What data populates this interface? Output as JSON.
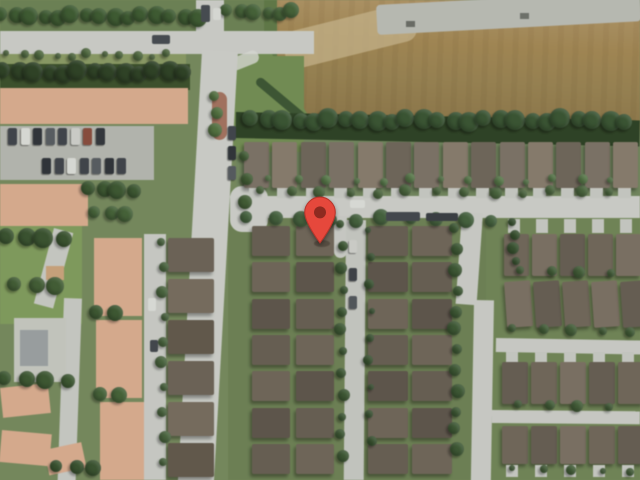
{
  "view": {
    "type": "satellite",
    "subject": "suburban residential neighborhood aerial view"
  },
  "marker": {
    "x": 320,
    "y": 244,
    "width": 36,
    "height": 48,
    "color": "#E6483C",
    "edge": "#B8352B",
    "dot": "#8E2A20"
  },
  "palette": {
    "grass_base": "#74875c",
    "road_gray": "#c8cac4",
    "dirt_field": "#9c8350",
    "concrete_strip": "#b7b9b1",
    "tree_green": "#3a5530",
    "townhouse_peach": "#d8a98a",
    "house_roof_brown": "#6e6456",
    "park_green": "#7d9a57"
  },
  "scene": {
    "ops": [
      {
        "t": "r",
        "n": "ground-top-strip",
        "x": 0,
        "y": 0,
        "w": 312,
        "h": 34,
        "c": "#6a8150"
      },
      {
        "t": "r",
        "n": "ground-houses-north",
        "x": 236,
        "y": 134,
        "w": 404,
        "h": 64,
        "c": "#6f855a"
      },
      {
        "t": "r",
        "n": "ground-block-left",
        "x": 228,
        "y": 214,
        "w": 260,
        "h": 266,
        "c": "#6b8050"
      },
      {
        "t": "r",
        "n": "ground-block-right",
        "x": 486,
        "y": 214,
        "w": 154,
        "h": 266,
        "c": "#6e8452"
      },
      {
        "t": "r",
        "n": "park-green",
        "x": 0,
        "y": 226,
        "w": 82,
        "h": 98,
        "c": "#7d9a57"
      },
      {
        "t": "r",
        "n": "dirt-field",
        "x": 274,
        "y": 0,
        "w": 366,
        "h": 130,
        "cls": "g-field"
      },
      {
        "t": "r",
        "n": "field-light-patch",
        "x": 280,
        "y": 34,
        "w": 134,
        "h": 38,
        "c": "#c6b286",
        "rot": -14,
        "rad": "12px",
        "op": 0.75
      },
      {
        "t": "r",
        "n": "field-concrete-strip",
        "x": 376,
        "y": 5,
        "w": 264,
        "h": 30,
        "c": "#b7b9b1",
        "rot": -3,
        "rad": "4px"
      },
      {
        "t": "r",
        "n": "strip-vehicle",
        "x": 406,
        "y": 21,
        "w": 9,
        "h": 6,
        "c": "#686b63"
      },
      {
        "t": "r",
        "n": "strip-vehicle",
        "x": 520,
        "y": 13,
        "w": 9,
        "h": 6,
        "c": "#6d7068"
      },
      {
        "t": "r",
        "n": "field-west-hedge",
        "x": 264,
        "y": 0,
        "w": 13,
        "h": 70,
        "c": "#5d7843"
      },
      {
        "t": "r",
        "n": "grass-field-corner",
        "x": 258,
        "y": 54,
        "w": 54,
        "h": 68,
        "c": "#6f8c4e",
        "clip": "polygon(0 0,26% 0,100% 100%,0 100%)"
      },
      {
        "t": "r",
        "n": "grass-ne-patch",
        "x": 234,
        "y": 56,
        "w": 70,
        "h": 96,
        "c": "#6f8c4e"
      },
      {
        "t": "r",
        "n": "boundary-hedge",
        "x": 260,
        "y": 76,
        "w": 66,
        "h": 9,
        "c": "#3a5530",
        "rot": 40,
        "rad": "5px"
      },
      {
        "t": "r",
        "n": "field-treeline",
        "x": 236,
        "y": 112,
        "w": 404,
        "h": 26,
        "c": "#2b4122",
        "rot": 1.2
      },
      {
        "t": "r",
        "n": "road-horizontal",
        "x": 0,
        "y": 31,
        "w": 314,
        "h": 23,
        "c": "#c8cac4"
      },
      {
        "t": "r",
        "n": "road-stub-north",
        "x": 196,
        "y": 0,
        "w": 28,
        "h": 34,
        "c": "#c8cac4"
      },
      {
        "t": "r",
        "n": "sidewalk-corner",
        "x": 228,
        "y": 60,
        "w": 30,
        "h": 13,
        "c": "#d6d7d1",
        "rot": -22,
        "rad": "6px",
        "op": 0.8
      },
      {
        "t": "r",
        "n": "road-main-vertical",
        "x": 202,
        "y": 50,
        "w": 36,
        "h": 436,
        "c": "#c9cbc5",
        "rot": 3.2
      },
      {
        "t": "r",
        "n": "street-pin",
        "x": 230,
        "y": 196,
        "w": 410,
        "h": 22,
        "c": "#c9cbc5"
      },
      {
        "t": "r",
        "n": "street-pin-mouth",
        "x": 230,
        "y": 186,
        "w": 38,
        "h": 46,
        "c": "#c9cbc5",
        "rad": "12px"
      },
      {
        "t": "r",
        "n": "street-right-vertical-a",
        "x": 462,
        "y": 212,
        "w": 21,
        "h": 92,
        "c": "#c7c9c3",
        "rot": 4
      },
      {
        "t": "r",
        "n": "street-right-vertical-b",
        "x": 474,
        "y": 300,
        "w": 20,
        "h": 182,
        "c": "#c7c9c3",
        "rot": 1
      },
      {
        "t": "r",
        "n": "street-right-h2",
        "x": 496,
        "y": 338,
        "w": 146,
        "h": 14,
        "c": "#c7c9c3",
        "rot": 1
      },
      {
        "t": "r",
        "n": "street-right-h3",
        "x": 492,
        "y": 410,
        "w": 148,
        "h": 13,
        "c": "#c7c9c3",
        "rot": 0.5
      },
      {
        "t": "r",
        "n": "street-left-vertical",
        "x": 144,
        "y": 234,
        "w": 22,
        "h": 246,
        "c": "#c6c8c2"
      },
      {
        "t": "r",
        "n": "road-curve-a",
        "x": 54,
        "y": 228,
        "w": 20,
        "h": 78,
        "c": "#c4c6c0",
        "rot": 15
      },
      {
        "t": "r",
        "n": "road-curve-b",
        "x": 64,
        "y": 298,
        "w": 18,
        "h": 184,
        "c": "#c4c6c0",
        "rot": 2
      },
      {
        "t": "r",
        "n": "lane-culdesac",
        "x": 334,
        "y": 216,
        "w": 13,
        "h": 42,
        "c": "#c6c8c2",
        "rad": "0 0 7px 7px"
      },
      {
        "t": "r",
        "n": "lane-mid",
        "x": 346,
        "y": 220,
        "w": 20,
        "h": 260,
        "c": "#c2c4be",
        "rot": 0.5
      },
      {
        "t": "r",
        "n": "median-grass",
        "x": 0,
        "y": 54,
        "w": 186,
        "h": 10,
        "c": "#87985f"
      },
      {
        "t": "r",
        "n": "median-brick",
        "x": 212,
        "y": 92,
        "w": 15,
        "h": 48,
        "c": "#a4705b",
        "rad": "8px"
      },
      {
        "t": "r",
        "n": "tree-shadow-band",
        "x": 0,
        "y": 64,
        "w": 190,
        "h": 26,
        "c": "#3a5028"
      },
      {
        "t": "r",
        "n": "townhouse-roof",
        "x": 0,
        "y": 88,
        "w": 188,
        "h": 36,
        "c": "#d8a98a",
        "cls": "g-peach-h"
      },
      {
        "t": "r",
        "n": "parking-lot",
        "x": 0,
        "y": 126,
        "w": 154,
        "h": 54,
        "c": "#b2b4ac"
      },
      {
        "t": "r",
        "n": "townhouse-roof",
        "x": 0,
        "y": 184,
        "w": 88,
        "h": 42,
        "c": "#d8a98a",
        "cls": "g-peach-h"
      },
      {
        "t": "r",
        "n": "pavilion-roof",
        "x": 46,
        "y": 266,
        "w": 18,
        "h": 14,
        "c": "#c9a077",
        "cls": "g-hip"
      },
      {
        "t": "r",
        "n": "clubhouse-deck",
        "x": 14,
        "y": 318,
        "w": 52,
        "h": 64,
        "c": "#c2c4bc"
      },
      {
        "t": "r",
        "n": "clubhouse-roof",
        "x": 20,
        "y": 330,
        "w": 28,
        "h": 36,
        "c": "#989e9f",
        "cls": "g-hip"
      },
      {
        "t": "r",
        "n": "townhouse-roof",
        "x": 0,
        "y": 388,
        "w": 48,
        "h": 30,
        "c": "#d8a98a",
        "cls": "g-peach-h",
        "rot": -6
      },
      {
        "t": "r",
        "n": "townhouse-roof",
        "x": 2,
        "y": 430,
        "w": 50,
        "h": 32,
        "c": "#d8a98a",
        "cls": "g-peach-h",
        "rot": 5
      },
      {
        "t": "r",
        "n": "townhouse-roof",
        "x": 44,
        "y": 450,
        "w": 38,
        "h": 26,
        "c": "#d8a98a",
        "cls": "g-peach-h",
        "rot": -12
      },
      {
        "t": "r",
        "n": "townhouse-roof",
        "x": 94,
        "y": 238,
        "w": 48,
        "h": 78,
        "c": "#d8a98a",
        "cls": "g-peach-v"
      },
      {
        "t": "r",
        "n": "townhouse-roof",
        "x": 96,
        "y": 320,
        "w": 46,
        "h": 78,
        "c": "#d8a98a",
        "cls": "g-peach-v"
      },
      {
        "t": "r",
        "n": "townhouse-roof",
        "x": 100,
        "y": 402,
        "w": 44,
        "h": 78,
        "c": "#d8a98a",
        "cls": "g-peach-v"
      },
      {
        "t": "row",
        "n": "house",
        "x": 244,
        "y": 142,
        "dx": 28.4,
        "cnt": 14,
        "w": 25,
        "h": 46,
        "cls": "g-roof-v",
        "cs": [
          "#7b7163",
          "#867a69",
          "#6d6457"
        ]
      },
      {
        "t": "row",
        "n": "driveway",
        "x": 249,
        "y": 188,
        "dx": 28.4,
        "cnt": 14,
        "w": 13,
        "h": 10,
        "cs": [
          "#c3c5bf"
        ]
      },
      {
        "t": "col",
        "n": "house",
        "x": 252,
        "y": 226,
        "dy": 36.3,
        "cnt": 7,
        "w": 38,
        "h": 30,
        "cls": "g-hip",
        "cs": [
          "#665d50",
          "#6e6456",
          "#5d5449"
        ]
      },
      {
        "t": "col",
        "n": "house",
        "x": 296,
        "y": 226,
        "dy": 36.3,
        "cnt": 7,
        "w": 38,
        "h": 30,
        "cls": "g-hip",
        "cs": [
          "#6e6456",
          "#5d5449",
          "#665d50"
        ]
      },
      {
        "t": "col",
        "n": "house",
        "x": 368,
        "y": 226,
        "dy": 36.3,
        "cnt": 7,
        "w": 40,
        "h": 30,
        "cls": "g-hip",
        "cs": [
          "#665d50",
          "#5d5449",
          "#6e6456"
        ]
      },
      {
        "t": "col",
        "n": "house",
        "x": 412,
        "y": 226,
        "dy": 36.3,
        "cnt": 7,
        "w": 40,
        "h": 30,
        "cls": "g-hip",
        "cs": [
          "#6e6456",
          "#665d50",
          "#5d5449"
        ]
      },
      {
        "t": "col",
        "n": "house",
        "x": 168,
        "y": 238,
        "dy": 41,
        "cnt": 6,
        "w": 46,
        "h": 34,
        "cls": "g-hip",
        "cs": [
          "#6b6154",
          "#756a5b",
          "#615749"
        ]
      },
      {
        "t": "row",
        "n": "driveway",
        "x": 508,
        "y": 219,
        "dx": 28,
        "cnt": 5,
        "w": 12,
        "h": 14,
        "cs": [
          "#c3c5bf"
        ]
      },
      {
        "t": "row",
        "n": "house",
        "x": 504,
        "y": 234,
        "dx": 28,
        "cnt": 5,
        "w": 25,
        "h": 42,
        "cls": "g-hip",
        "cs": [
          "#6f6557",
          "#7a6f60",
          "#655c50"
        ]
      },
      {
        "t": "row",
        "n": "house",
        "x": 504,
        "y": 282,
        "dx": 29,
        "cnt": 5,
        "w": 26,
        "h": 46,
        "cls": "g-hip",
        "rot": -4,
        "cs": [
          "#7a6f60",
          "#655c50",
          "#6f6557"
        ]
      },
      {
        "t": "row",
        "n": "driveway",
        "x": 506,
        "y": 352,
        "dx": 29,
        "cnt": 5,
        "w": 12,
        "h": 11,
        "cs": [
          "#c3c5bf"
        ]
      },
      {
        "t": "row",
        "n": "house",
        "x": 502,
        "y": 362,
        "dx": 29,
        "cnt": 5,
        "w": 26,
        "h": 42,
        "cls": "g-hip",
        "cs": [
          "#655c50",
          "#6f6557",
          "#7a6f60"
        ]
      },
      {
        "t": "row",
        "n": "house",
        "x": 502,
        "y": 426,
        "dx": 29,
        "cnt": 5,
        "w": 26,
        "h": 38,
        "cls": "g-hip",
        "cs": [
          "#6f6557",
          "#655c50",
          "#7a6f60"
        ]
      },
      {
        "t": "row",
        "n": "driveway",
        "x": 506,
        "y": 465,
        "dx": 29,
        "cnt": 5,
        "w": 12,
        "h": 12,
        "cs": [
          "#c3c5bf"
        ]
      },
      {
        "t": "trees",
        "n": "tree",
        "x": 2,
        "y": 16,
        "dx": 14,
        "cnt": 15,
        "r": 8,
        "c": "#3b5a2e"
      },
      {
        "t": "trees",
        "n": "tree",
        "x": 228,
        "y": 12,
        "dx": 13,
        "cnt": 6,
        "r": 7,
        "c": "#426134"
      },
      {
        "t": "trees",
        "n": "tree",
        "x": 8,
        "y": 55,
        "dx": 16,
        "cnt": 11,
        "r": 4,
        "c": "#4c683a"
      },
      {
        "t": "trees",
        "n": "tree",
        "x": 4,
        "y": 72,
        "dx": 15,
        "cnt": 13,
        "r": 9,
        "c": "#2c4123"
      },
      {
        "t": "trees",
        "n": "tree",
        "x": 252,
        "y": 120,
        "dx": 15.5,
        "cnt": 25,
        "r": 9,
        "c": "#375430"
      },
      {
        "t": "trees",
        "n": "tree",
        "x": 248,
        "y": 219,
        "dx": 27,
        "cnt": 10,
        "r": 7,
        "c": "#41603a"
      },
      {
        "t": "trees",
        "n": "tree",
        "x": 262,
        "y": 192,
        "dx": 29,
        "cnt": 13,
        "r": 5,
        "c": "#476439"
      },
      {
        "t": "trees",
        "n": "bush",
        "x": 270,
        "y": 180,
        "dx": 28.4,
        "cnt": 13,
        "r": 4,
        "c": "#547844"
      },
      {
        "t": "trees",
        "n": "tree",
        "x": 342,
        "y": 226,
        "dy": 21,
        "cnt": 12,
        "r": 5,
        "c": "#3a5730"
      },
      {
        "t": "trees",
        "n": "tree",
        "x": 370,
        "y": 232,
        "dy": 26,
        "cnt": 9,
        "r": 4,
        "c": "#35512c"
      },
      {
        "t": "trees",
        "n": "tree",
        "x": 456,
        "y": 230,
        "dy": 20,
        "cnt": 12,
        "r": 6,
        "c": "#3a5730"
      },
      {
        "t": "trees",
        "n": "tree",
        "x": 163,
        "y": 244,
        "dy": 24,
        "cnt": 10,
        "r": 5,
        "c": "#46633a"
      },
      {
        "t": "trees",
        "n": "tree",
        "x": 8,
        "y": 238,
        "dx": 18,
        "cnt": 4,
        "r": 9,
        "c": "#37522c"
      },
      {
        "t": "trees",
        "n": "tree",
        "x": 16,
        "y": 286,
        "dx": 20,
        "cnt": 3,
        "r": 8,
        "c": "#3f5c31"
      },
      {
        "t": "trees",
        "n": "palm-tree",
        "x": 216,
        "y": 98,
        "dy": 16,
        "cnt": 3,
        "r": 6,
        "c": "#50703c"
      },
      {
        "t": "trees",
        "n": "tree",
        "x": 246,
        "y": 158,
        "dy": 22,
        "cnt": 3,
        "r": 6,
        "c": "#3f5c31"
      },
      {
        "t": "trees",
        "n": "tree",
        "x": 90,
        "y": 190,
        "dx": 14,
        "cnt": 4,
        "r": 8,
        "c": "#3a572e"
      },
      {
        "t": "trees",
        "n": "tree",
        "x": 96,
        "y": 214,
        "dx": 15,
        "cnt": 3,
        "r": 7,
        "c": "#426134"
      },
      {
        "t": "trees",
        "n": "tree",
        "x": 98,
        "y": 314,
        "dx": 16,
        "cnt": 2,
        "r": 8,
        "c": "#3a572e"
      },
      {
        "t": "trees",
        "n": "tree",
        "x": 102,
        "y": 396,
        "dx": 16,
        "cnt": 2,
        "r": 8,
        "c": "#426134"
      },
      {
        "t": "trees",
        "n": "tree",
        "x": 6,
        "y": 380,
        "dx": 20,
        "cnt": 4,
        "r": 8,
        "c": "#3a572e"
      },
      {
        "t": "trees",
        "n": "tree",
        "x": 58,
        "y": 468,
        "dx": 18,
        "cnt": 3,
        "r": 7,
        "c": "#37522c"
      },
      {
        "t": "trees",
        "n": "tree",
        "x": 522,
        "y": 272,
        "dx": 29,
        "cnt": 4,
        "r": 5,
        "c": "#3f5c33"
      },
      {
        "t": "trees",
        "n": "tree",
        "x": 514,
        "y": 330,
        "dx": 29,
        "cnt": 5,
        "r": 5,
        "c": "#3f5c33"
      },
      {
        "t": "trees",
        "n": "tree",
        "x": 520,
        "y": 406,
        "dx": 29,
        "cnt": 4,
        "r": 5,
        "c": "#3f5c33"
      },
      {
        "t": "trees",
        "n": "tree",
        "x": 514,
        "y": 470,
        "dx": 29,
        "cnt": 5,
        "r": 4,
        "c": "#3f5c33"
      },
      {
        "t": "trees",
        "n": "hedge",
        "x": 514,
        "y": 224,
        "dy": 12,
        "cnt": 4,
        "r": 5,
        "c": "#35512c"
      },
      {
        "t": "cars",
        "n": "parked-car",
        "x": 8,
        "y": 128,
        "dx": 12.5,
        "cnt": 8,
        "w": 9,
        "h": 17,
        "cs": [
          "#3e4349",
          "#d7d9d3",
          "#2e3338",
          "#565b60",
          "#3e4349",
          "#caccc6",
          "#8a4a3a",
          "#31363b"
        ]
      },
      {
        "t": "cars",
        "n": "parked-car",
        "x": 42,
        "y": 158,
        "dx": 12.5,
        "cnt": 7,
        "w": 9,
        "h": 16,
        "cs": [
          "#2e3338",
          "#3e4349",
          "#d7d9d3",
          "#3e4349",
          "#565b60",
          "#2e3338",
          "#3e4349"
        ]
      },
      {
        "t": "cars",
        "n": "parked-car",
        "x": 228,
        "y": 126,
        "dy": 20,
        "cnt": 3,
        "w": 8,
        "h": 14,
        "cs": [
          "#3f444a",
          "#2f3438",
          "#54595e"
        ]
      },
      {
        "t": "cars",
        "n": "parked-car",
        "x": 349,
        "y": 240,
        "dy": 28,
        "cnt": 3,
        "w": 8,
        "h": 13,
        "cs": [
          "#caccc6",
          "#3c4146",
          "#50555a"
        ]
      },
      {
        "t": "r",
        "n": "truck",
        "x": 386,
        "y": 212,
        "w": 34,
        "h": 9,
        "c": "#41464c",
        "rad": "2px"
      },
      {
        "t": "r",
        "n": "truck",
        "x": 426,
        "y": 213,
        "w": 32,
        "h": 8,
        "c": "#383d42",
        "rad": "2px"
      },
      {
        "t": "r",
        "n": "car",
        "x": 350,
        "y": 200,
        "w": 15,
        "h": 8,
        "c": "#d8dad4",
        "rad": "2px"
      },
      {
        "t": "r",
        "n": "car",
        "x": 152,
        "y": 35,
        "w": 18,
        "h": 9,
        "c": "#454a50",
        "rad": "2px"
      },
      {
        "t": "r",
        "n": "truck",
        "x": 201,
        "y": 5,
        "w": 9,
        "h": 17,
        "c": "#454a4f",
        "rad": "2px"
      },
      {
        "t": "r",
        "n": "car",
        "x": 213,
        "y": 8,
        "w": 8,
        "h": 12,
        "c": "#d6d8d2",
        "rad": "2px"
      },
      {
        "t": "r",
        "n": "car",
        "x": 148,
        "y": 298,
        "w": 8,
        "h": 13,
        "c": "#d8dad4",
        "rad": "2px"
      },
      {
        "t": "r",
        "n": "car",
        "x": 150,
        "y": 340,
        "w": 8,
        "h": 12,
        "c": "#41464b",
        "rad": "2px"
      },
      {
        "t": "r",
        "n": "marker-shadow",
        "x": 314,
        "y": 240,
        "w": 16,
        "h": 7,
        "c": "rgba(40,30,20,.35)",
        "rad": "50%"
      }
    ]
  }
}
